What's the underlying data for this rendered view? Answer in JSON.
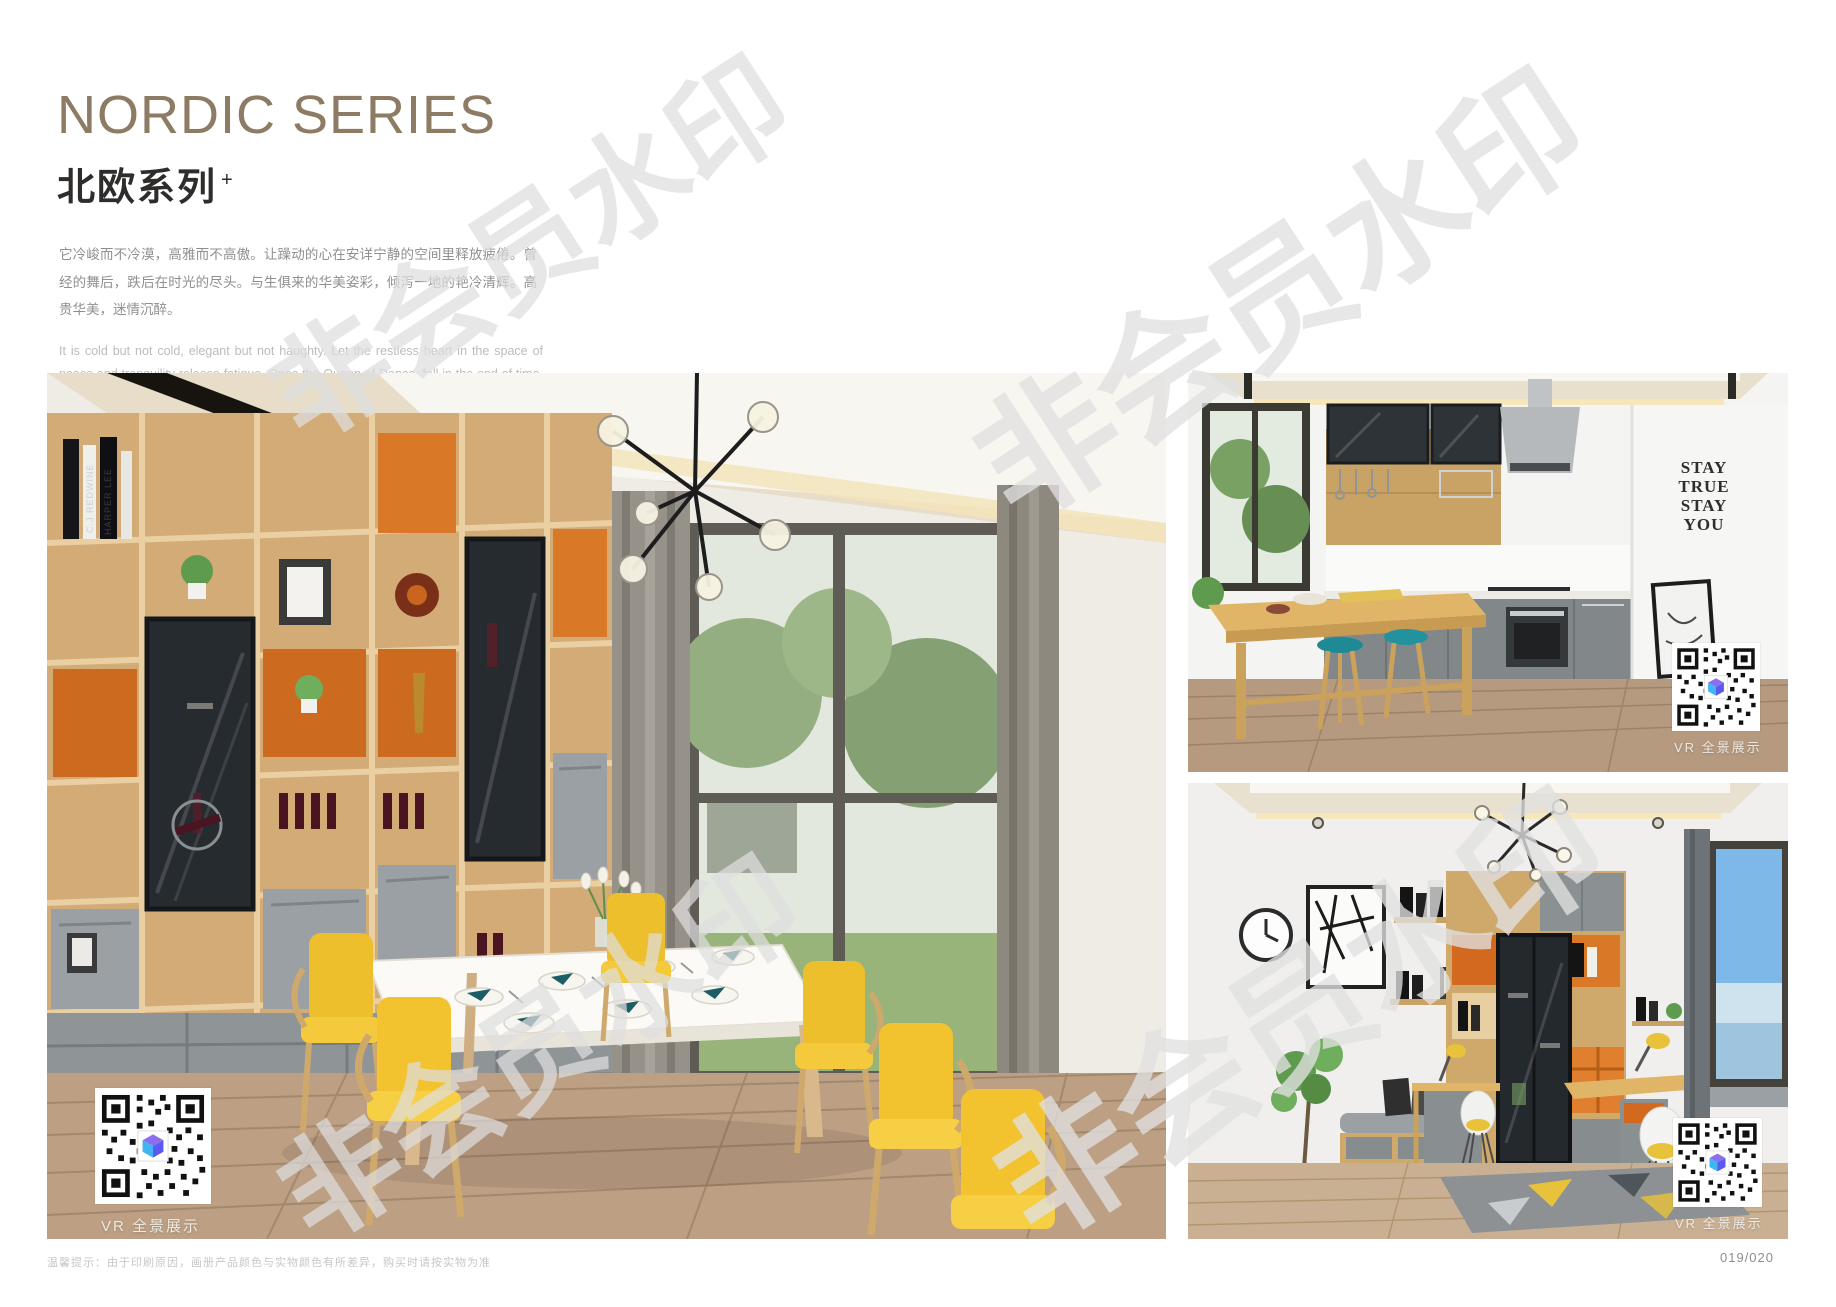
{
  "header": {
    "title_en": "NORDIC SERIES",
    "title_cn": "北欧系列",
    "title_sup": "+",
    "paragraph_cn": "它冷峻而不冷漠，高雅而不高傲。让躁动的心在安详宁静的空间里释放疲倦。曾经的舞后，跌后在时光的尽头。与生俱来的华美姿彩，倾泻一地的艳冷清辉。高贵华美，迷情沉醉。",
    "paragraph_en": "It is cold but not cold, elegant but not haughty. Let the restless heart in the space of peace and tranquility release fatigue. Once the Queen of Dance, fall in the end of time. The natural beauty of the beautiful, pouring a land of cold and pure brilliance. Noble, beautiful, enchanted."
  },
  "watermark": {
    "text": "非会员水印"
  },
  "photos": {
    "main": {
      "vr_label": "VR 全景展示",
      "book_spines": [
        "C.J REDWINE",
        "HARPER LEE"
      ]
    },
    "kitchen": {
      "vr_label": "VR 全景展示",
      "wall_decal_lines": [
        "STAY",
        "TRUE",
        "STAY",
        "YOU"
      ]
    },
    "study": {
      "vr_label": "VR 全景展示"
    }
  },
  "footer": {
    "disclaimer": "温馨提示：由于印刷原因，画册产品颜色与实物颜色有所差异，购买时请按实物为准",
    "page_number": "019/020"
  },
  "colors": {
    "title_accent": "#8d7b63",
    "wood": "#d2ab76",
    "cabinet_orange": "#cc6a1f",
    "chair_yellow": "#f2c32e",
    "stool_teal": "#1f8a96",
    "watermark_gray": "#e0e0e0"
  }
}
